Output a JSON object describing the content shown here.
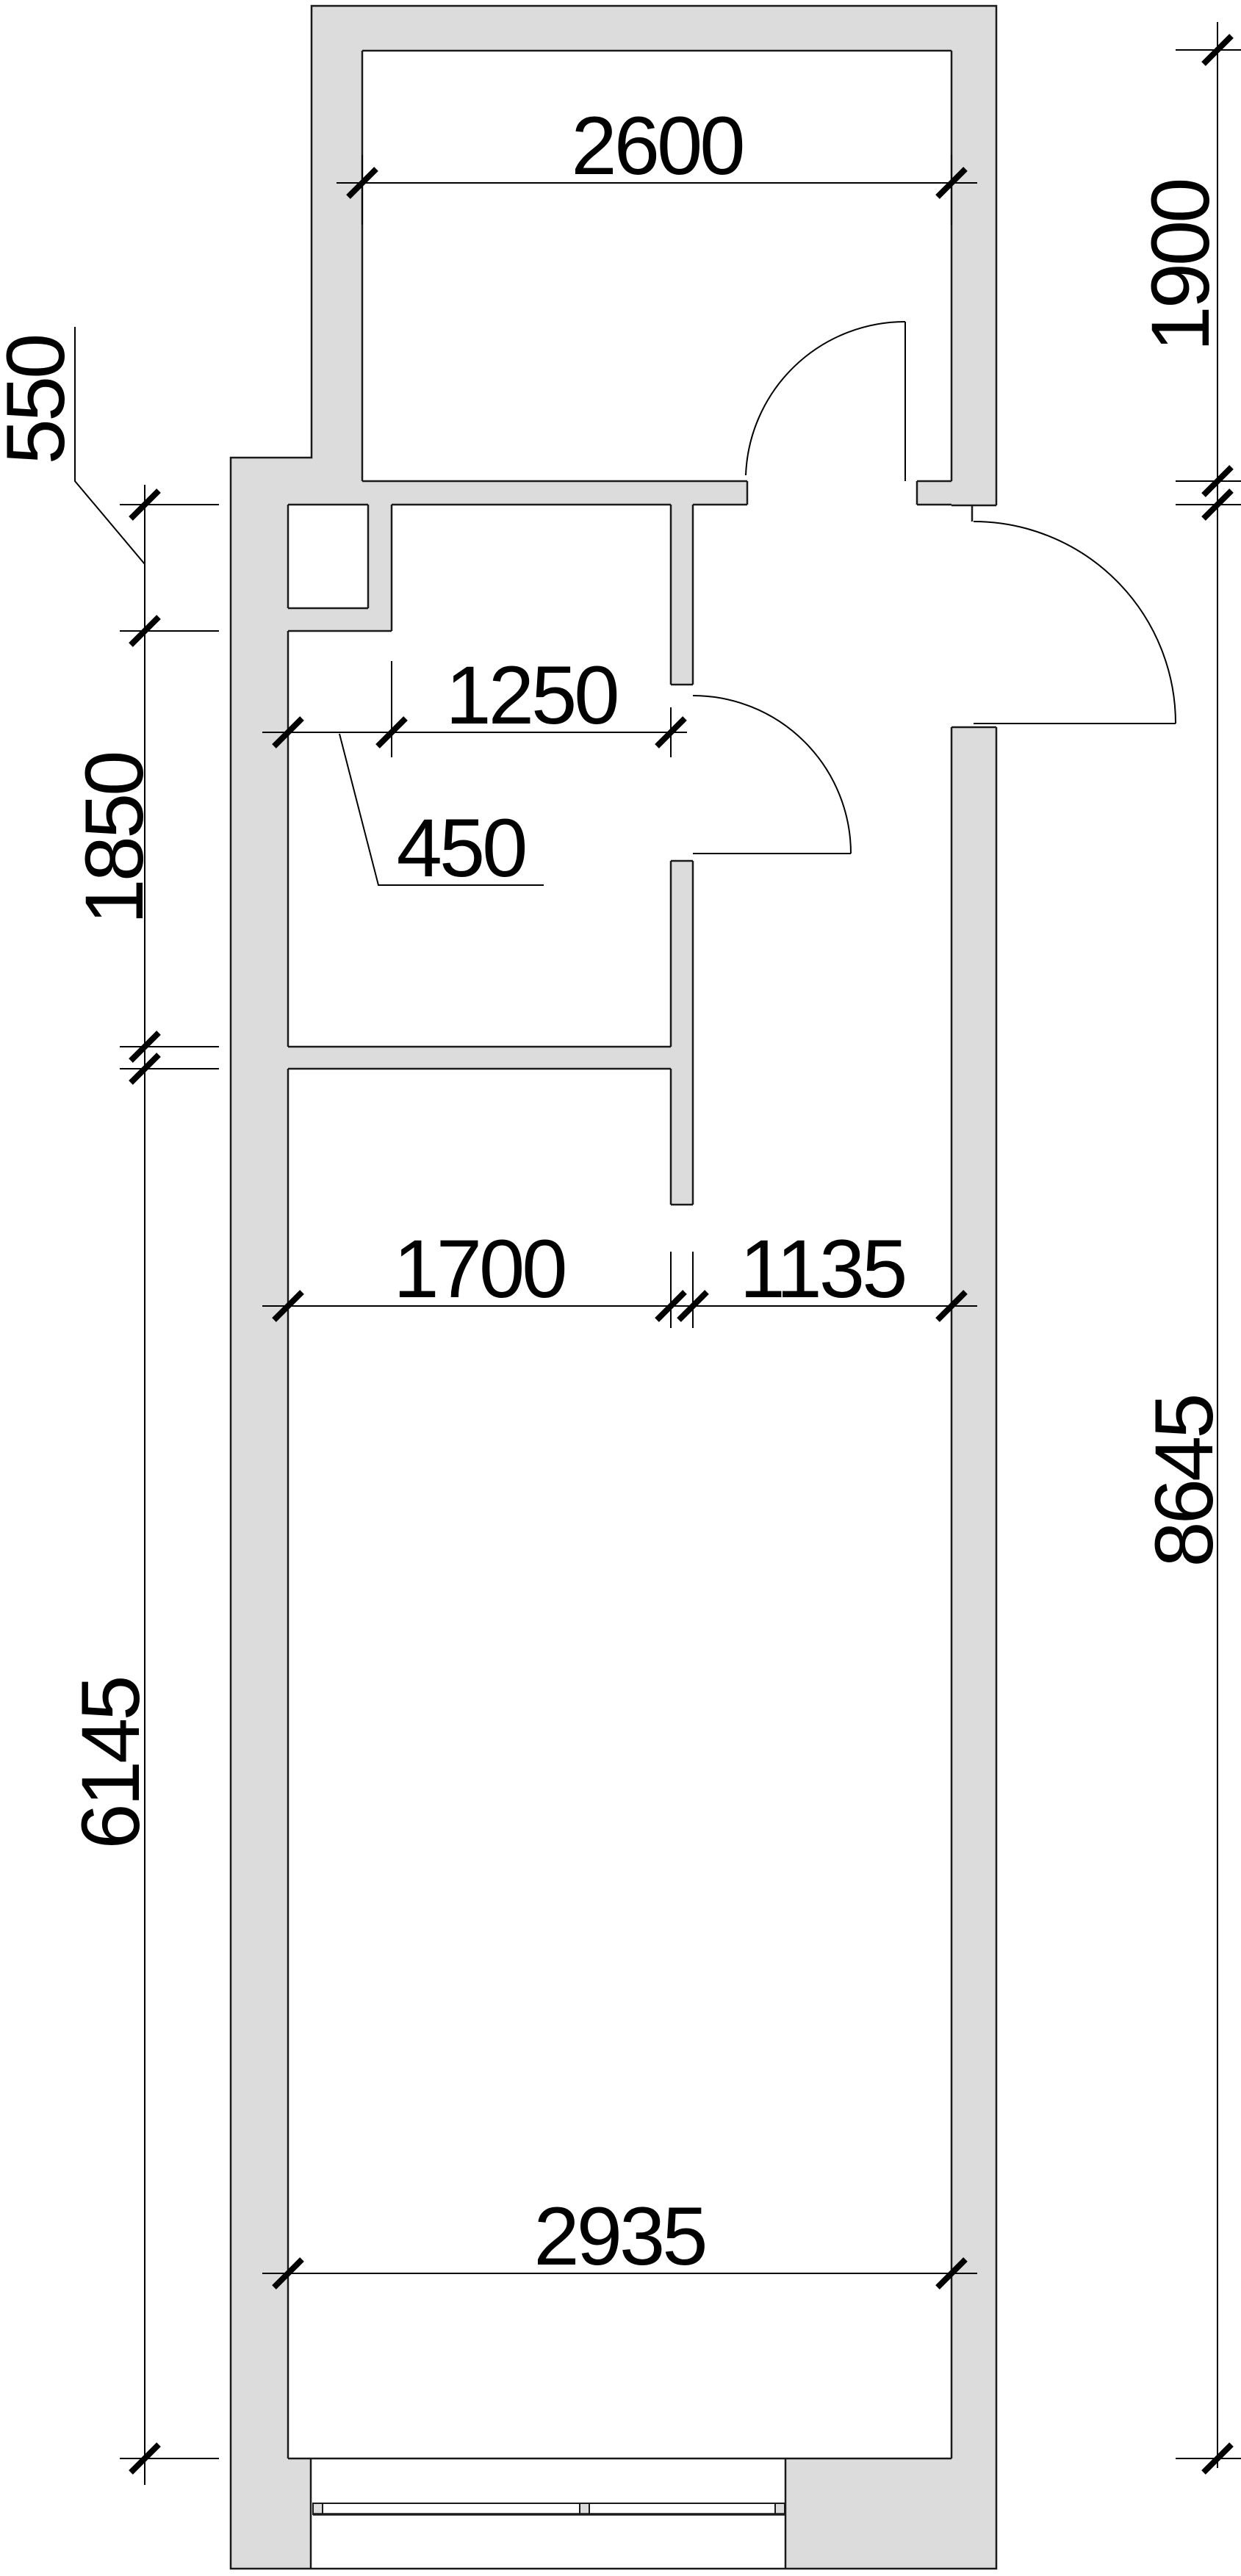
{
  "drawing": {
    "type": "architectural-floor-plan",
    "units": "mm",
    "colors": {
      "wall_fill": "#dcdcdc",
      "outline": "#1a1a1a",
      "dimension": "#000000",
      "background": "#ffffff"
    },
    "dimensions": {
      "top_room_width": {
        "label": "2600"
      },
      "top_room_height": {
        "label": "1900"
      },
      "left_offset": {
        "label": "550"
      },
      "hall_width": {
        "label": "1250"
      },
      "niche_width": {
        "label": "450"
      },
      "left_hall_height": {
        "label": "1850"
      },
      "room_split_left": {
        "label": "1700"
      },
      "room_split_right": {
        "label": "1135"
      },
      "right_total_height": {
        "label": "8645"
      },
      "left_room_height": {
        "label": "6145"
      },
      "room_width": {
        "label": "2935"
      }
    }
  }
}
